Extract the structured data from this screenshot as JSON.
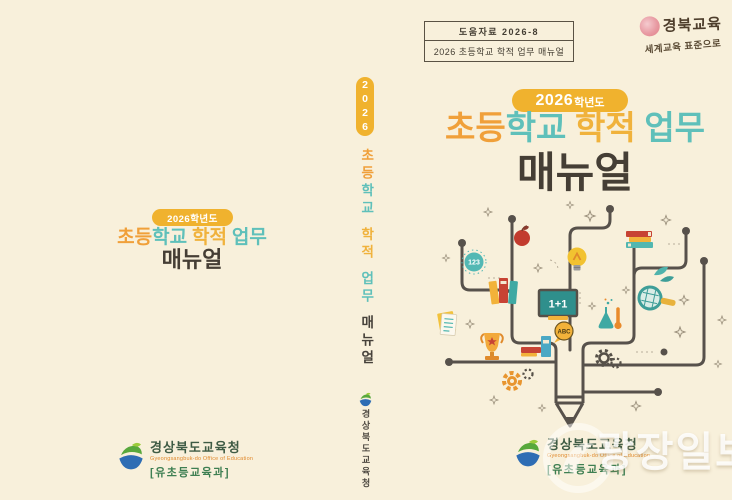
{
  "header": {
    "ref_box": {
      "line1": "도움자료 2026-8",
      "line2": "2026 초등학교 학적 업무 매뉴얼"
    },
    "stamp": {
      "brand": "경북교육",
      "slogan": "세계교육 표준으로",
      "seal_color": "#E89AA2"
    }
  },
  "title": {
    "badge_full": "2026학년도",
    "badge_year": "2026",
    "badge_suffix": "학년도",
    "parts": [
      {
        "text": "초등",
        "color": "#F0A03A"
      },
      {
        "text": "학교",
        "color": "#5FC0BA"
      },
      {
        "text": "학적",
        "color": "#F0B23C"
      },
      {
        "text": "업무",
        "color": "#5FC0BA"
      }
    ],
    "subtitle": "매뉴얼"
  },
  "spine": {
    "year": "2026",
    "parts": [
      {
        "text": "초등",
        "color": "#F0A03A"
      },
      {
        "text": "학교",
        "color": "#5FC0BA"
      },
      {
        "text": "학적",
        "color": "#F0B23C"
      },
      {
        "text": "업무",
        "color": "#5FC0BA"
      },
      {
        "text": "매뉴얼",
        "color": "#46413A"
      }
    ],
    "publisher": "경상북도교육청"
  },
  "illustration": {
    "badge_123": "123",
    "board_text": "1+1",
    "abc_text": "ABC",
    "icons": [
      "apple-icon",
      "lightbulb-icon",
      "books-stack-icon",
      "leaves-icon",
      "magnifier-icon",
      "chalkboard-icon",
      "abc-badge-icon",
      "flask-icon",
      "thermometer-icon",
      "gears-icon",
      "trophy-icon",
      "documents-icon",
      "books-icon",
      "pencil-trunk-icon",
      "sparkle-icons",
      "number-badge-icon"
    ]
  },
  "footer": {
    "org_name": "경상북도교육청",
    "org_name_en": "Gyeongsangbuk-do Office of Education",
    "dept": "[유초등교육과]"
  },
  "watermark": {
    "text": "광장일보"
  },
  "colors": {
    "background": "#F8F0DB",
    "orange": "#F0A03A",
    "amber": "#F0B23C",
    "teal": "#5FC0BA",
    "gold_badge": "#F0B22E",
    "dark_text": "#453E35",
    "branch": "#57514B",
    "seal_pink": "#E89AA2",
    "org_green": "#3E5B44",
    "dept_green": "#3E7F52",
    "org_en_orange": "#E08A2E",
    "watermark_white": "#FFFFFF"
  }
}
